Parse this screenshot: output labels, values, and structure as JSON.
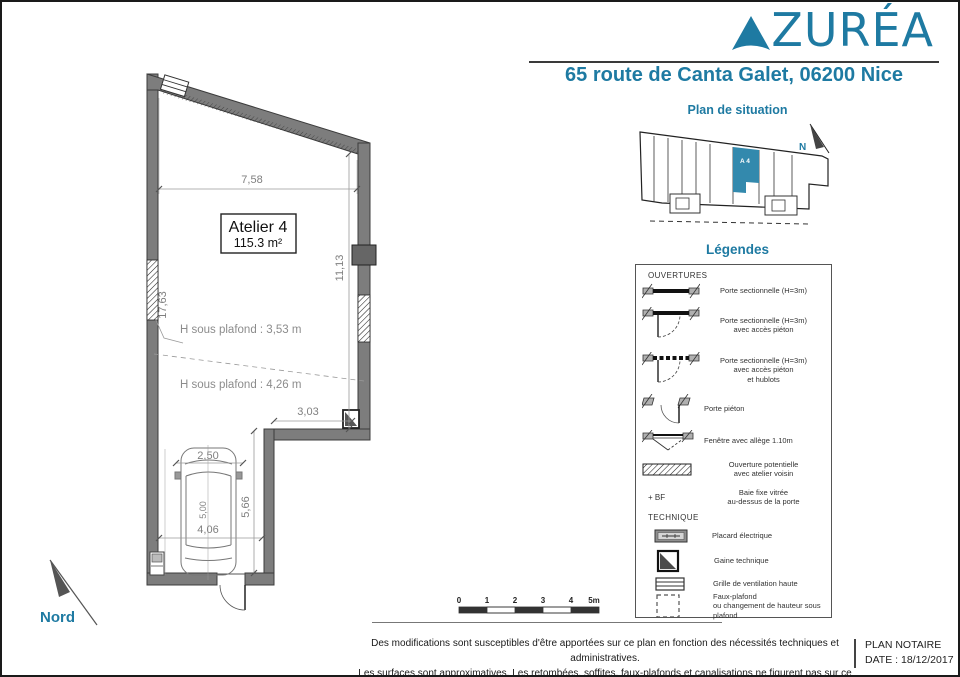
{
  "colors": {
    "accent": "#1e7aa2",
    "unit_fill": "#3389ad",
    "wall_gray": "#7d7d7d"
  },
  "header": {
    "brand": "ZURÉA",
    "address": "65 route de Canta Galet, 06200 Nice"
  },
  "situation": {
    "title": "Plan de situation",
    "unit_label": "A 4",
    "north_label": "N"
  },
  "plan": {
    "room_name": "Atelier 4",
    "room_area": "115.3 m²",
    "ceiling_height_1": "H sous plafond : 3,53 m",
    "ceiling_height_2": "H sous plafond : 4,26 m",
    "north_label": "Nord",
    "dims": {
      "top_width": "7,58",
      "right_height": "11,13",
      "left_height": "17,63",
      "recess_width": "3,03",
      "parking_width": "2,50",
      "lower_depth": "5,66",
      "parking_length": "5,00",
      "lower_width": "4,06"
    }
  },
  "legend": {
    "title": "Légendes",
    "sections": {
      "openings": "OUVERTURES",
      "technical": "TECHNIQUE"
    },
    "items": [
      {
        "icon": "sectional-door-icon",
        "label": "Porte sectionnelle (H=3m)"
      },
      {
        "icon": "sectional-door-pedestrian-icon",
        "label": "Porte sectionnelle (H=3m)\navec accès piéton"
      },
      {
        "icon": "sectional-door-pedestrian-portholes-icon",
        "label": "Porte sectionnelle (H=3m)\navec accès piéton\net hublots"
      },
      {
        "icon": "pedestrian-door-icon",
        "label": "Porte piéton"
      },
      {
        "icon": "window-sill-icon",
        "label": "Fenêtre avec allège 1.10m"
      },
      {
        "icon": "hatched-opening-icon",
        "label": "Ouverture potentielle\navec atelier voisin"
      },
      {
        "icon": "fixed-glazing-symbol",
        "symbol": "+ BF",
        "label": "Baie fixe vitrée\nau-dessus de la porte"
      },
      {
        "icon": "electrical-closet-icon",
        "label": "Placard électrique"
      },
      {
        "icon": "technical-duct-icon",
        "label": "Gaine technique"
      },
      {
        "icon": "ventilation-grille-icon",
        "label": "Grille de ventilation haute"
      },
      {
        "icon": "false-ceiling-icon",
        "label": "Faux-plafond\nou changement de hauteur sous plafond"
      }
    ]
  },
  "scale_bar": {
    "ticks": [
      "0",
      "1",
      "2",
      "3",
      "4",
      "5m"
    ]
  },
  "footer": {
    "disclaimer_line1": "Des modifications sont susceptibles d'être apportées sur ce plan en fonction des nécessités techniques et administratives.",
    "disclaimer_line2": "Les surfaces sont approximatives. Les retombées, soffites, faux-plafonds et canalisations ne figurent pas sur ce plan.",
    "document_type": "PLAN NOTAIRE",
    "date": "DATE : 18/12/2017"
  }
}
